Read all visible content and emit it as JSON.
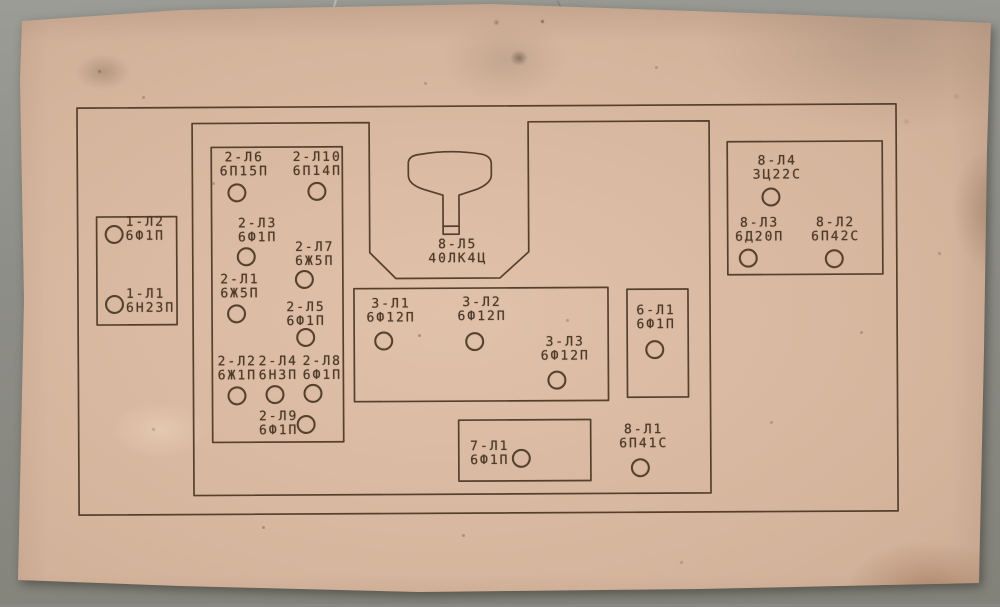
{
  "photo": {
    "background_color": "#8e8e88",
    "paper_color": "#d6b59d",
    "ink_color": "#55402e"
  },
  "diagram": {
    "crt": {
      "designation": "8-Л5",
      "type": "40ЛК4Ц"
    },
    "units": [
      {
        "id": "unit-1",
        "tubes": [
          {
            "designation": "1-Л2",
            "type": "6Ф1П"
          },
          {
            "designation": "1-Л1",
            "type": "6Н23П"
          }
        ]
      },
      {
        "id": "unit-2",
        "tubes": [
          {
            "designation": "2-Л6",
            "type": "6П15П"
          },
          {
            "designation": "2-Л10",
            "type": "6П14П"
          },
          {
            "designation": "2-Л3",
            "type": "6Ф1П"
          },
          {
            "designation": "2-Л7",
            "type": "6Ж5П"
          },
          {
            "designation": "2-Л1",
            "type": "6Ж5П"
          },
          {
            "designation": "2-Л5",
            "type": "6Ф1П"
          },
          {
            "designation": "2-Л2",
            "type": "6Ж1П"
          },
          {
            "designation": "2-Л4",
            "type": "6Н3П"
          },
          {
            "designation": "2-Л8",
            "type": "6Ф1П"
          },
          {
            "designation": "2-Л9",
            "type": "6Ф1П"
          }
        ]
      },
      {
        "id": "unit-3",
        "tubes": [
          {
            "designation": "3-Л1",
            "type": "6Ф12П"
          },
          {
            "designation": "3-Л2",
            "type": "6Ф12П"
          },
          {
            "designation": "3-Л3",
            "type": "6Ф12П"
          }
        ]
      },
      {
        "id": "unit-6",
        "tubes": [
          {
            "designation": "6-Л1",
            "type": "6Ф1П"
          }
        ]
      },
      {
        "id": "unit-8-rectifier",
        "tubes": [
          {
            "designation": "8-Л4",
            "type": "3Ц22С"
          },
          {
            "designation": "8-Л3",
            "type": "6Д20П"
          },
          {
            "designation": "8-Л2",
            "type": "6П42С"
          }
        ]
      },
      {
        "id": "unit-7",
        "tubes": [
          {
            "designation": "7-Л1",
            "type": "6Ф1П"
          }
        ]
      },
      {
        "id": "unit-8-output",
        "tubes": [
          {
            "designation": "8-Л1",
            "type": "6П41С"
          }
        ]
      }
    ]
  }
}
